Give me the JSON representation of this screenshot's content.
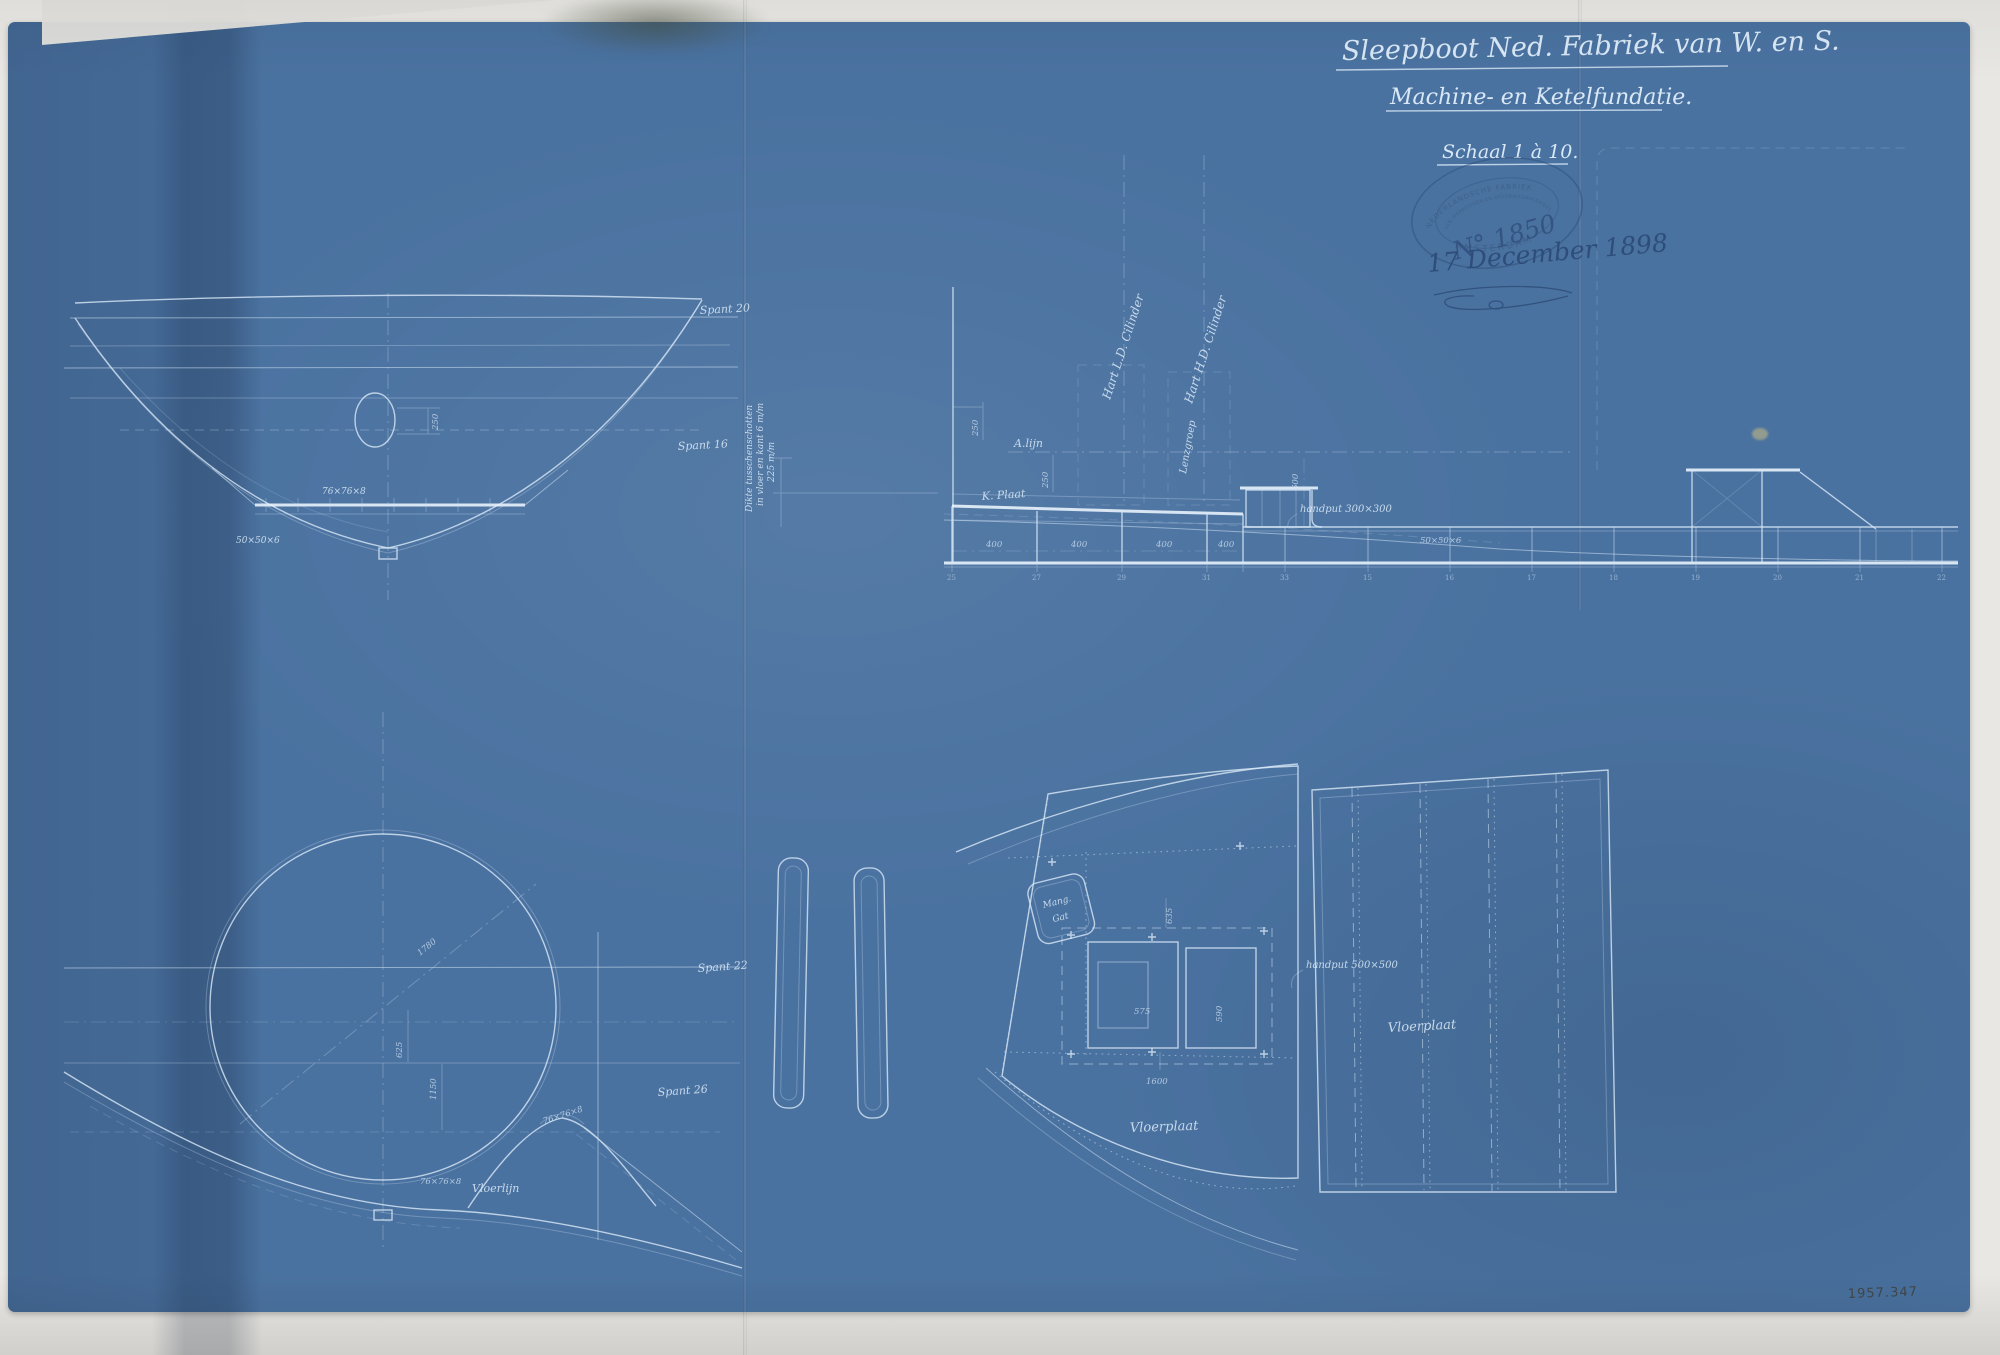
{
  "document": {
    "title": "Sleepboot Ned. Fabriek van W. en S.",
    "subtitle": "Machine- en Ketelfundatie.",
    "scale": "Schaal 1 à 10.",
    "sheet_number": "1957.347"
  },
  "stamp": {
    "org_line1": "NEDERLANDSCHE FABRIEK",
    "org_line2": "VAN WERKTUIGEN EN SPOORWEGMATERIEEL",
    "city": "AMSTERDAM",
    "number": "N° 1850",
    "date": "17 December 1898"
  },
  "body_section": {
    "spant_top": "Spant 20",
    "spant_mid": "Spant 16",
    "dim_manhole": "250",
    "profile_a": "76×76×8",
    "profile_b": "50×50×6"
  },
  "elevation": {
    "hart_ld": "Hart L.D. Cilinder",
    "hart_hd": "Hart H.D. Cilinder",
    "a_lijn": "A.lijn",
    "k_plaat": "K. Plaat",
    "lenzgroep": "Lenzgroep",
    "handput": "handput 300×300",
    "profile": "50×50×6",
    "dim_250a": "250",
    "dim_250b": "250",
    "dim_600": "600",
    "bay_dims": [
      "400",
      "400",
      "400",
      "400"
    ],
    "frames_left": [
      "25",
      "27",
      "29",
      "31",
      "33"
    ],
    "frames_right": [
      "15",
      "16",
      "17",
      "18",
      "19",
      "20",
      "21",
      "22"
    ],
    "side_note": [
      "Dikte tusschenschotten",
      "in vloer en kant 6 m/m",
      "225 m/m"
    ]
  },
  "boiler_section": {
    "diameter": "1780",
    "dim_1150": "1150",
    "dim_625": "625",
    "profile_a": "76×76×8",
    "profile_b": "76×76×8",
    "vloerlijn": "Vloerlijn",
    "spant_a": "Spant 22",
    "spant_b": "Spant 26"
  },
  "plan": {
    "mangat_line1": "Mang.",
    "mangat_line2": "Gat",
    "dim_635": "635",
    "dim_575": "575",
    "dim_590": "590",
    "dim_1600": "1600",
    "handput": "handput 500×500",
    "vloerplaat_left": "Vloerplaat",
    "vloerplaat_right": "Vloerplaat"
  },
  "colors": {
    "sheet_blue": "#4a72a0",
    "line_pale": "#d6e7f6",
    "ink_blue": "#2c4a77",
    "paper": "#e8e7e3"
  }
}
